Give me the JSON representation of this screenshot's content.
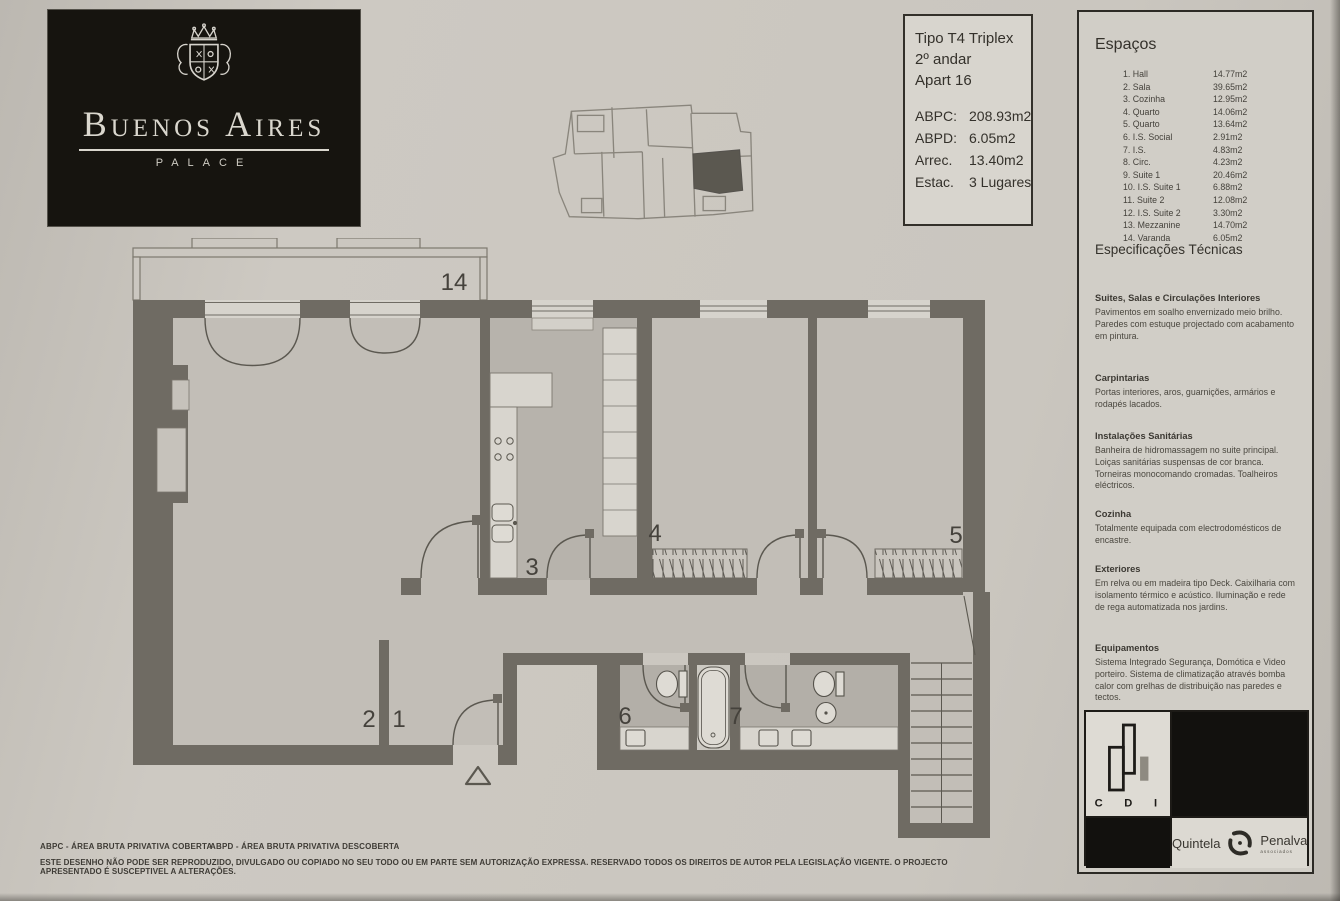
{
  "brand": {
    "name": "Buenos Aires",
    "subtitle": "Palace"
  },
  "title_block": {
    "type": "Tipo T4 Triplex",
    "floor": "2º andar",
    "apartment": "Apart 16",
    "rows": [
      {
        "label": "ABPC:",
        "value": "208.93m2"
      },
      {
        "label": "ABPD:",
        "value": "6.05m2"
      },
      {
        "label": "Arrec.",
        "value": "13.40m2"
      },
      {
        "label": "Estac.",
        "value": "3 Lugares"
      }
    ]
  },
  "spaces_panel": {
    "title": "Espaços",
    "items": [
      {
        "label": "1. Hall",
        "area": "14.77m2"
      },
      {
        "label": "2. Sala",
        "area": "39.65m2"
      },
      {
        "label": "3. Cozinha",
        "area": "12.95m2"
      },
      {
        "label": "4. Quarto",
        "area": "14.06m2"
      },
      {
        "label": "5. Quarto",
        "area": "13.64m2"
      },
      {
        "label": "6. I.S. Social",
        "area": "2.91m2"
      },
      {
        "label": "7. I.S.",
        "area": "4.83m2"
      },
      {
        "label": "8. Circ.",
        "area": "4.23m2"
      },
      {
        "label": "9. Suite 1",
        "area": "20.46m2"
      },
      {
        "label": "10. I.S. Suite 1",
        "area": "6.88m2"
      },
      {
        "label": "11. Suite 2",
        "area": "12.08m2"
      },
      {
        "label": "12. I.S. Suite 2",
        "area": "3.30m2"
      },
      {
        "label": "13. Mezzanine",
        "area": "14.70m2"
      },
      {
        "label": "14. Varanda",
        "area": "6.05m2"
      }
    ],
    "specs_title": "Especificações Técnicas",
    "specs": [
      {
        "heading": "Suites, Salas e Circulações Interiores",
        "body": "Pavimentos em soalho envernizado meio brilho. Paredes com estuque projectado com acabamento em pintura."
      },
      {
        "heading": "Carpintarias",
        "body": "Portas interiores, aros, guarnições, armários e rodapés lacados."
      },
      {
        "heading": "Instalações Sanitárias",
        "body": "Banheira de hidromassagem no suite principal. Loiças sanitárias suspensas de cor branca. Torneiras monocomando cromadas. Toalheiros eléctricos."
      },
      {
        "heading": "Cozinha",
        "body": "Totalmente equipada com electrodomésticos de encastre."
      },
      {
        "heading": "Exteriores",
        "body": "Em relva ou em madeira tipo Deck. Caixilharia com isolamento térmico e acústico. Iluminação e rede de rega automatizada nos jardins."
      },
      {
        "heading": "Equipamentos",
        "body": "Sistema Integrado Segurança, Domótica e Video porteiro. Sistema de climatização através bomba calor com grelhas de distribuição nas paredes e tectos."
      }
    ]
  },
  "plan": {
    "labels": {
      "hall": "1",
      "sala": "2",
      "cozinha": "3",
      "quarto_4": "4",
      "quarto_5": "5",
      "is_social": "6",
      "is_7": "7",
      "varanda": "14"
    }
  },
  "logos": {
    "cdi_letters": [
      "C",
      "D",
      "I"
    ],
    "partner": {
      "word1": "Quintela",
      "word2": "Penalva",
      "tagline": "associados"
    }
  },
  "footer": {
    "legend_abpc": "ABPC - ÁREA BRUTA PRIVATIVA COBERTA",
    "legend_abpd": "ABPD - ÁREA BRUTA PRIVATIVA DESCOBERTA",
    "disclaimer": "ESTE DESENHO NÃO PODE SER REPRODUZIDO, DIVULGADO OU COPIADO NO SEU TODO OU EM PARTE SEM AUTORIZAÇÃO EXPRESSA. RESERVADO TODOS OS DIREITOS DE AUTOR PELA LEGISLAÇÃO VIGENTE. O PROJECTO APRESENTADO É SUSCEPTIVEL A ALTERAÇÕES."
  },
  "colors": {
    "paper": "#c9c5be",
    "wall": "#6f6b63",
    "ink": "#3a3833",
    "logo_bg": "#16140f"
  }
}
